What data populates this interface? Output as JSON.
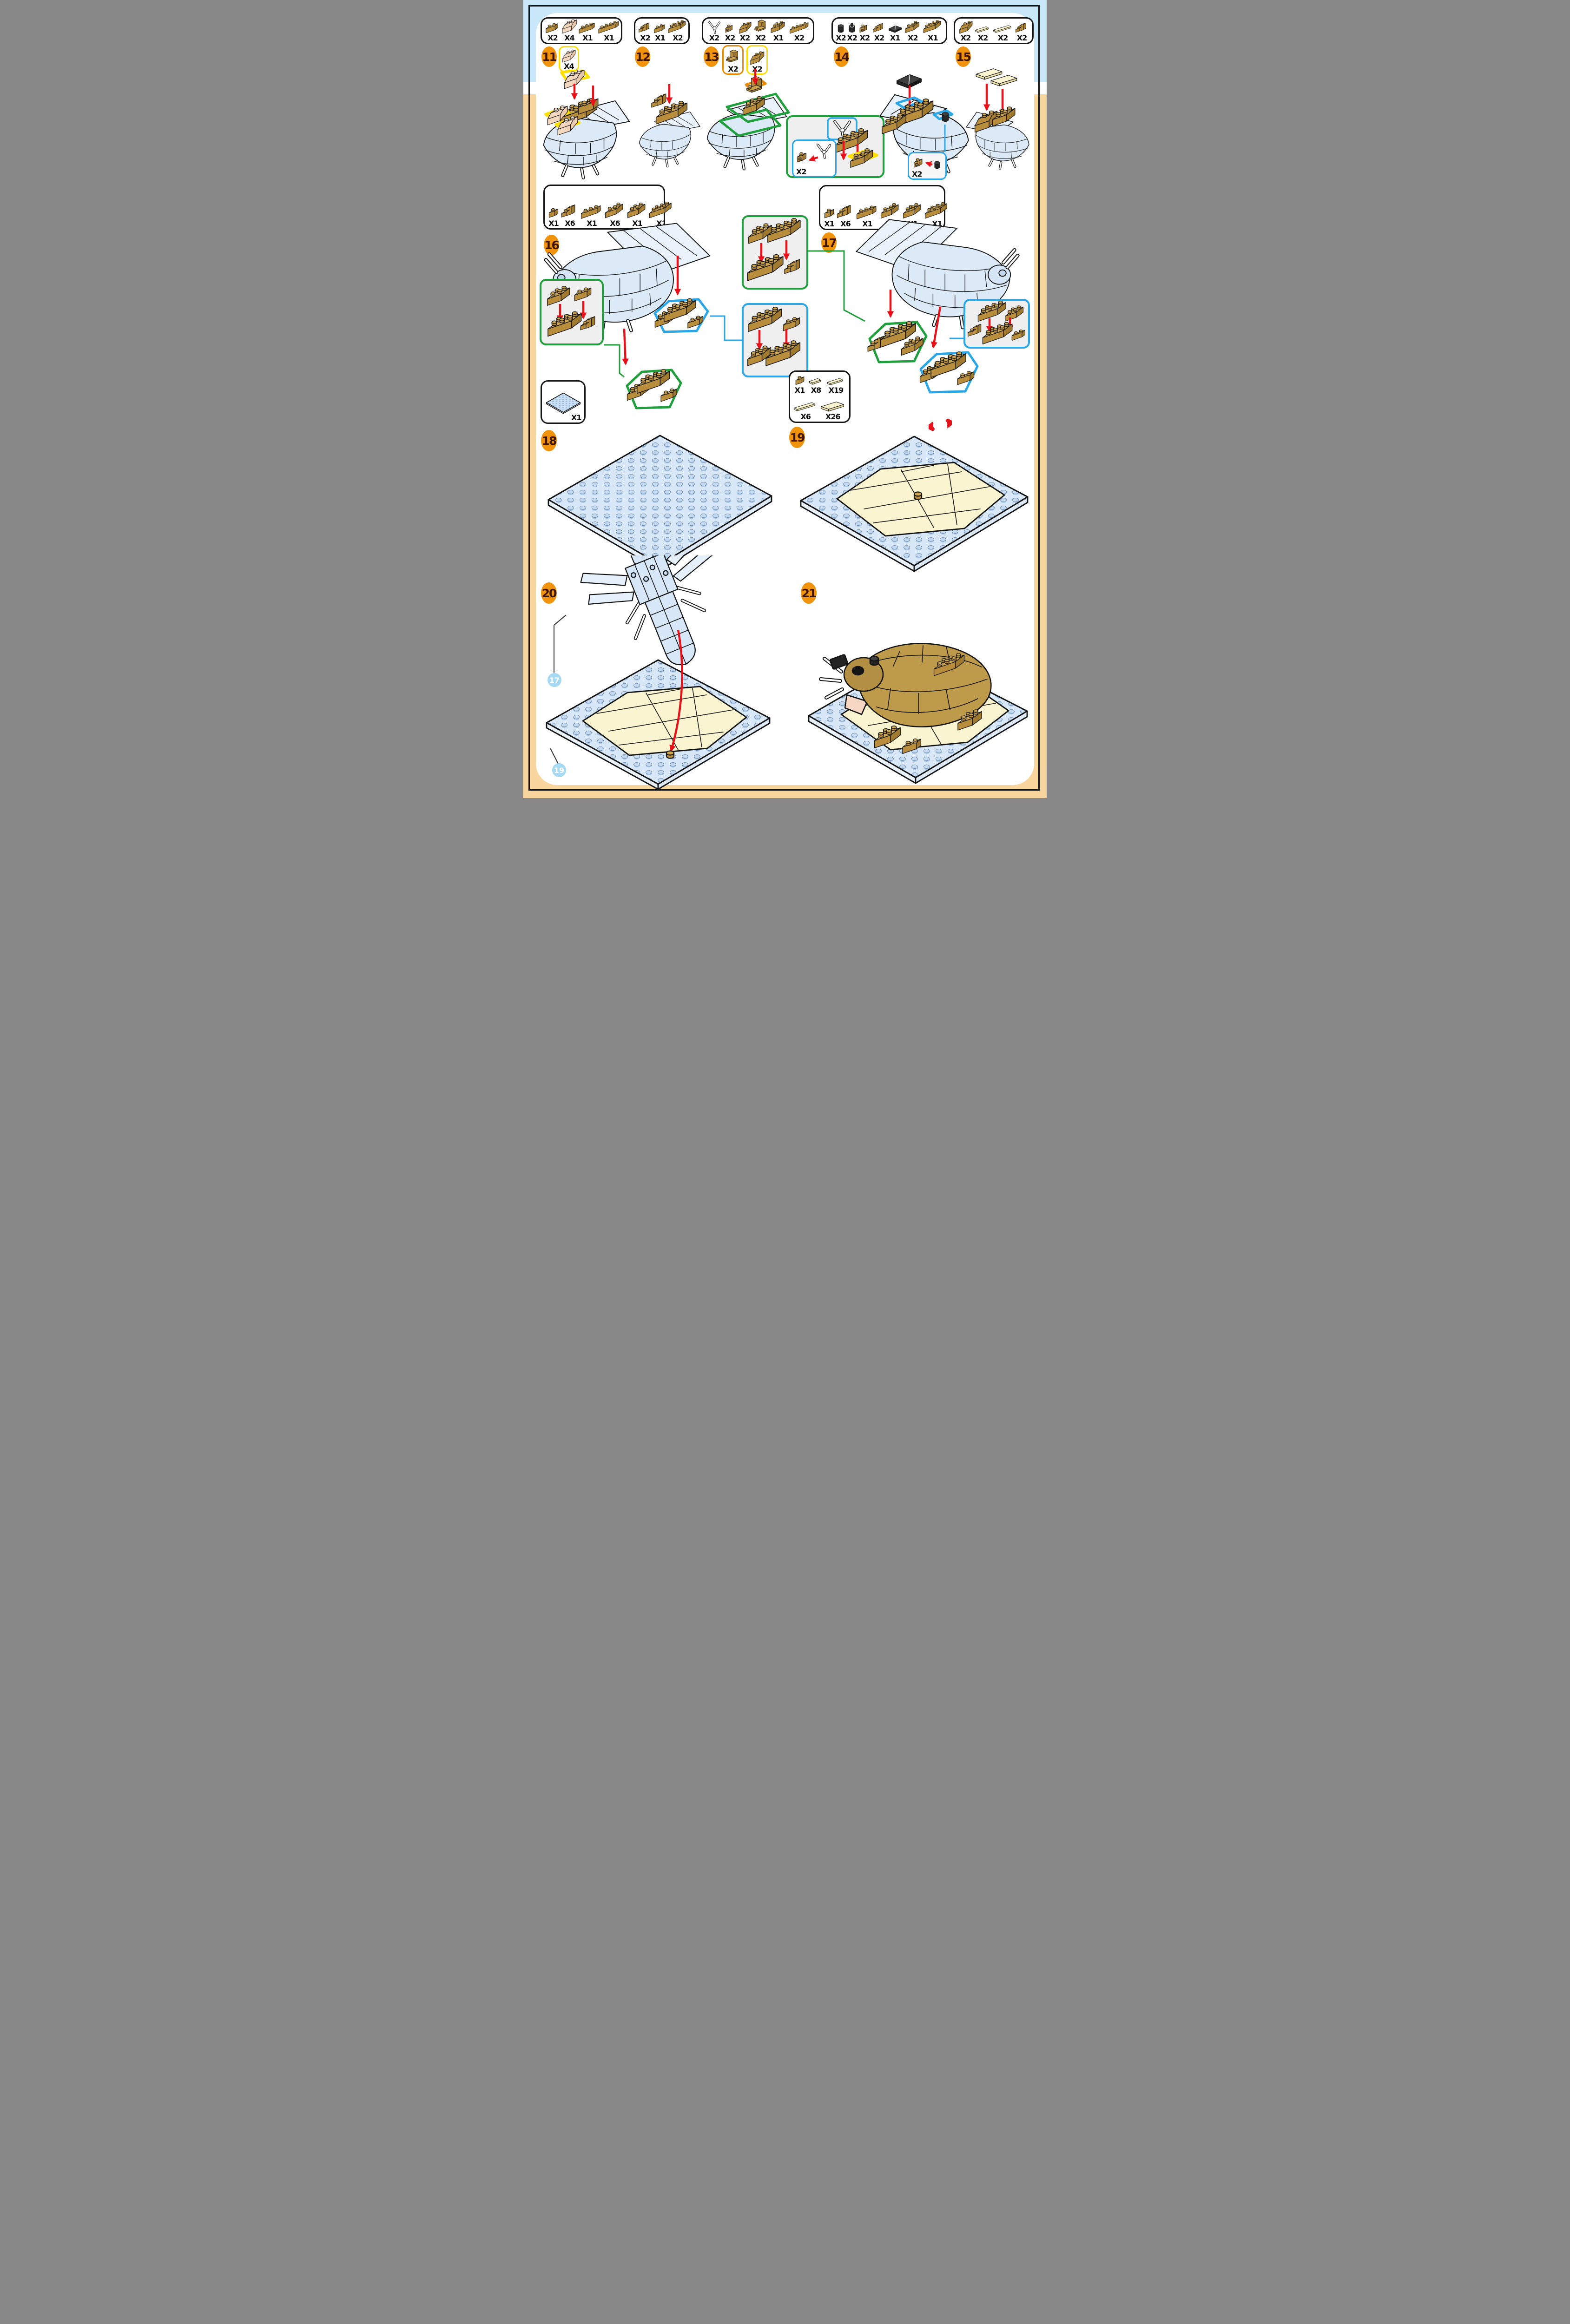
{
  "document": "brick-set building instructions page, steps 11-21",
  "colors": {
    "sky_band": "#C9E9FA",
    "sand_band": "#F8D69E",
    "badge_orange": "#F0930D",
    "badge_text": "#401500",
    "brick_tan": "#CDA64E",
    "brick_cream": "#FAE6D2",
    "plate_blue": "#D9E8F8",
    "tile_cream": "#FAF4D0",
    "highlight_yellow": "#FFDD00",
    "highlight_orange": "#E88B00",
    "highlight_green": "#1FA03C",
    "highlight_blue": "#2BA7E8",
    "arrow_red": "#E8111A"
  },
  "steps": [
    {
      "n": "11",
      "parts": [
        "X2",
        "X4",
        "X1",
        "X1"
      ],
      "callout": "X4"
    },
    {
      "n": "12",
      "parts": [
        "X2",
        "X1",
        "X2"
      ]
    },
    {
      "n": "13",
      "parts": [
        "X2",
        "X2",
        "X2",
        "X2",
        "X1",
        "X2"
      ],
      "callout_a": "X2",
      "callout_b": "X2",
      "inset": "X2"
    },
    {
      "n": "14",
      "parts": [
        "X2",
        "X2",
        "X2",
        "X2",
        "X1",
        "X2",
        "X1"
      ],
      "inset": "X2"
    },
    {
      "n": "15",
      "parts": [
        "X2",
        "X2",
        "X2",
        "X2"
      ]
    },
    {
      "n": "16",
      "parts": [
        "X1",
        "X6",
        "X1",
        "X6",
        "X1",
        "X1"
      ]
    },
    {
      "n": "17",
      "parts": [
        "X1",
        "X6",
        "X1",
        "X6",
        "X1",
        "X1"
      ]
    },
    {
      "n": "18",
      "parts": [
        "X1"
      ]
    },
    {
      "n": "19",
      "parts": [
        "X1",
        "X8",
        "X19",
        "X6",
        "X26"
      ]
    },
    {
      "n": "20",
      "refs": [
        "17",
        "19"
      ]
    },
    {
      "n": "21"
    }
  ]
}
